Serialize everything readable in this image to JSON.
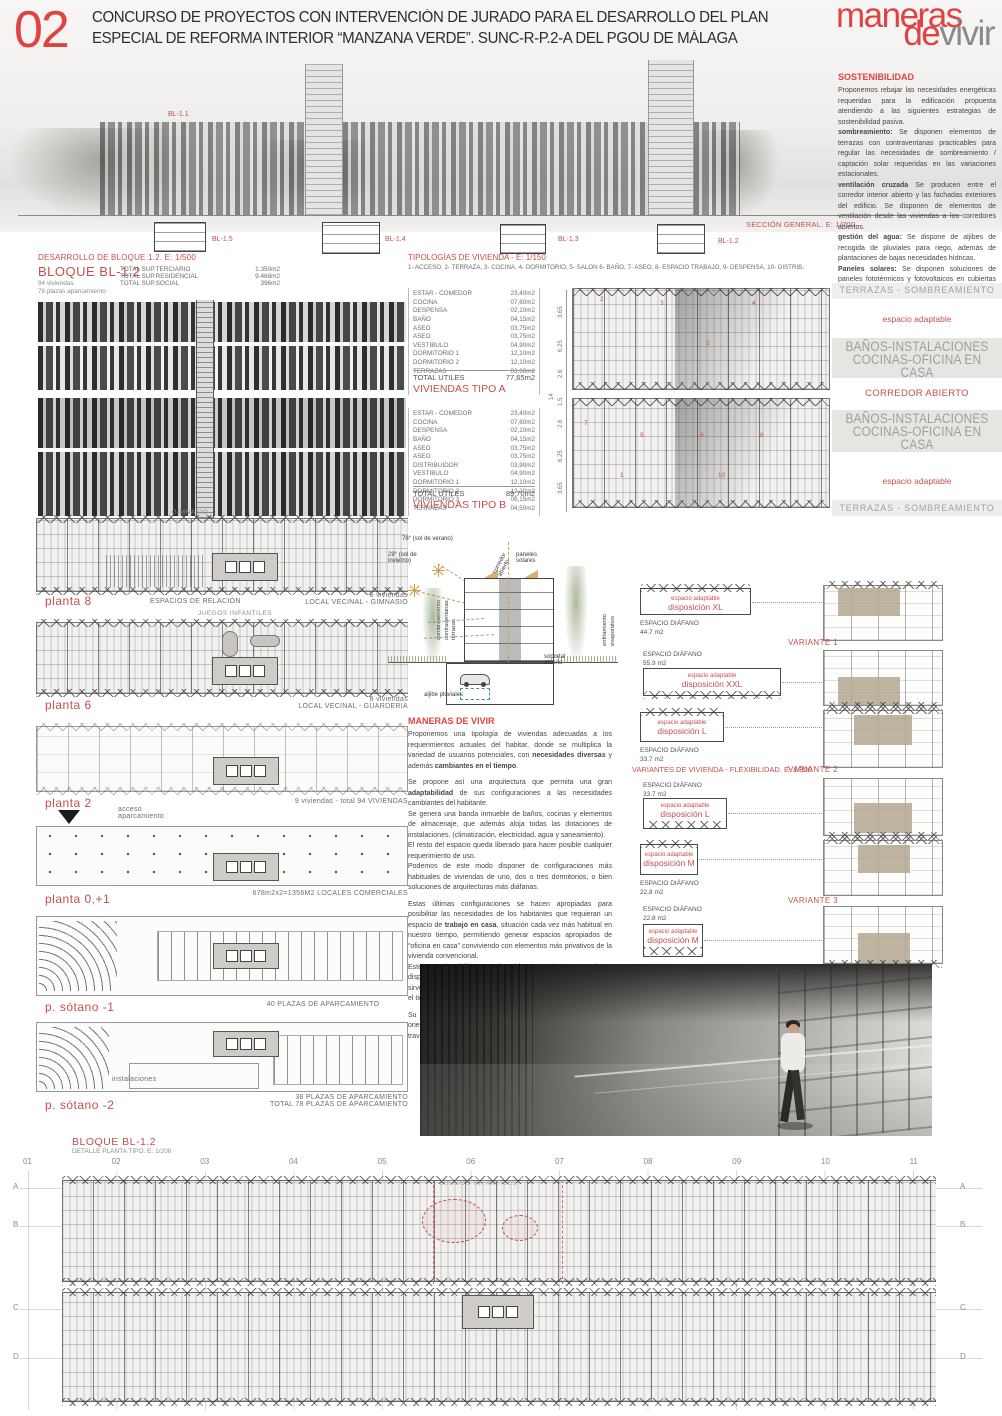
{
  "colors": {
    "accent": "#c4504e",
    "bright_red": "#e04343",
    "gray_label": "#8f8d8a",
    "tan": "#b3a791",
    "sun_orange": "#cf9b52"
  },
  "header": {
    "number": "02",
    "title_line1": "CONCURSO DE PROYECTOS CON INTERVENCIÓN DE JURADO PARA EL DESARROLLO  DEL PLAN",
    "title_line2": "ESPECIAL DE REFORMA INTERIOR “MANZANA VERDE”. SUNC-R-P.2-A  DEL  PGOU  DE  MÁLAGA",
    "logo": {
      "word1": "maneras",
      "word2": "de",
      "word3": "vivir"
    }
  },
  "seccion_general": {
    "bl_top": "BL-1.1",
    "labels": [
      "BL-1.5",
      "BL-1.4",
      "BL-1.3",
      "BL-1.2"
    ],
    "caption": "SECCIÓN GENERAL. E: 1/700"
  },
  "sostenibilidad": {
    "title": "SOSTENIBILIDAD",
    "paragraphs": [
      {
        "b": "",
        "t": "Proponemos rebajar las necesidades energéticas requeridas para la edificación propuesta atendiendo a las siguientes estrategias de sostenibilidad pasiva."
      },
      {
        "b": "sombreamiento:",
        "t": " Se disponen elementos de terrazas con contraventanas practicables para regular las necesidades de sombreamiento / captación solar requeridas en las variaciones estacionales."
      },
      {
        "b": "ventilación cruzada",
        "t": " Se producen entre el corredor interior abierto y las fachadas exteriores del edificio. Se disponen de elementos de ventilación desde las viviendas a los corredores abiertos."
      },
      {
        "b": "gestión del agua:",
        "t": " Se dispone de aljibes de recogida de pluviales para riego, además de plantaciones de bajas necesidades hídricas."
      },
      {
        "b": "Paneles solares:",
        "t": " Se disponen soluciones de paneles fototérmicos y fotovoltaicos en cubiertas para ayuda a la producción de frío/calor."
      }
    ]
  },
  "desarrollo": {
    "heading": "DESARROLLO DE BLOQUE 1.2. E: 1/500",
    "bloque": "BLOQUE  BL-1.2",
    "sub1": "94 viviendas",
    "sub2": "78 plazas aparcamiento",
    "stats": [
      {
        "label": "TOTAL SUP.TERCIARIO",
        "value": "1.350m2"
      },
      {
        "label": "TOTAL SUP.RESIDENCIAL",
        "value": "9.468m2"
      },
      {
        "label": "TOTAL SUP.SOCIAL",
        "value": "396m2"
      }
    ]
  },
  "tipologias": {
    "heading": "TIPOLOGÍAS DE VIVIENDA  -  E: 1/150",
    "legend": "1- ACCESO, 2- TERRAZA, 3- COCINA, 4- DORMITORIO, 5- SALON 6- BAÑO, 7- ASEO, 8- ESPACIO TRABAJO, 9- DESPENSA, 10- DISTRIB.",
    "tipo_a": {
      "rows": [
        [
          "ESTAR - COMEDOR",
          "23,40m2"
        ],
        [
          "COCINA",
          "07,60m2"
        ],
        [
          "DESPENSA",
          "02,10m2"
        ],
        [
          "BAÑO",
          "04,15m2"
        ],
        [
          "ASEO",
          "03,75m2"
        ],
        [
          "ASEO",
          "03,75m2"
        ],
        [
          "VESTIBULO",
          "04,90m2"
        ],
        [
          "DORMITORIO 1",
          "12,10m2"
        ],
        [
          "DORMITORIO 2",
          "12,10m2"
        ],
        [
          "TERRAZAS",
          "03,60m2"
        ]
      ],
      "total_label": "TOTAL UTILES",
      "total_value": "77,65m2",
      "name": "VIVIENDAS TIPO A"
    },
    "tipo_b": {
      "rows": [
        [
          "ESTAR - COMEDOR",
          "23,40m2"
        ],
        [
          "COCINA",
          "07,60m2"
        ],
        [
          "DESPENSA",
          "02,10m2"
        ],
        [
          "BAÑO",
          "04,15m2"
        ],
        [
          "ASEO",
          "03,75m2"
        ],
        [
          "ASEO",
          "03,75m2"
        ],
        [
          "DISTRIBUIDOR",
          "03,90m2"
        ],
        [
          "VESTIBULO",
          "04,90m2"
        ],
        [
          "DORMITORIO 1",
          "12,10m2"
        ],
        [
          "DORMITORIO 2",
          "12,10m2"
        ],
        [
          "DORMITORIO 3",
          "08,15m2"
        ],
        [
          "TERRAZAS",
          "04,50m2"
        ]
      ],
      "total_label": "TOTAL UTILES",
      "total_value": "89,70m2",
      "name": "VIVIENDAS TIPO B"
    },
    "dims_a": [
      "3.65",
      "6.25",
      "2.6"
    ],
    "dims_mid": [
      "14",
      "1.5"
    ],
    "dims_b": [
      "2.6",
      "6.25",
      "3.65"
    ],
    "plan_numbers": [
      "1",
      "2",
      "3",
      "4",
      "5",
      "6",
      "7",
      "8",
      "9",
      "10"
    ]
  },
  "franjas": {
    "top": "TERRAZAS - SOMBREAMIENTO",
    "adaptable1": "espacio adaptable",
    "banda1a": "BAÑOS-INSTALACIONES",
    "banda1b": "COCINAS-OFICINA EN CASA",
    "corredor": "CORREDOR ABIERTO",
    "banda2a": "BAÑOS-INSTALACIONES",
    "banda2b": "COCINAS-OFICINA EN CASA",
    "adaptable2": "espacio adaptable",
    "bottom": "TERRAZAS - SOMBREAMIENTO"
  },
  "plantas": {
    "gimnasio": "GIMNASIO",
    "planta8": {
      "name": "planta 8",
      "center": "ESPACIOS DE RELACIÓN",
      "right1": "8 viviendas",
      "right2": "LOCAL VECINAL - GIMNASIO"
    },
    "juegos": "JUEGOS INFANTILES",
    "planta6": {
      "name": "planta 6",
      "right1": "8 viviendas",
      "right2": "LOCAL VECINAL - GUARDERIA"
    },
    "planta2": {
      "name": "planta 2",
      "right1": "9 viviendas - total 94 VIVIENDAS",
      "acceso1": "acceso",
      "acceso2": "aparcamiento"
    },
    "planta01": {
      "name": "planta 0,+1",
      "right1": "678m2x2=1356M2 LOCALES COMERCIALES"
    },
    "sotano1": {
      "name": "p. sótano -1",
      "right1": "40 PLAZAS DE APARCAMIENTO"
    },
    "sotano2": {
      "name": "p. sótano -2",
      "inner": "instalaciones",
      "right1": "38 PLAZAS DE APARCAMIENTO",
      "right2": "TOTAL 78 PLAZAS DE APARCAMIENTO"
    }
  },
  "esquema": {
    "sol1": "78° (sol de verano)",
    "sol2": "29° (sol de invierno)",
    "vertical": "sombreamiento contraventanas terrazas",
    "corredor": "corredor abierto",
    "paneles": "paneles solares",
    "enfriamiento": "enfriamiento evaporativo",
    "soportal": "soportal abierto",
    "aljibe": "aljibe pluviales"
  },
  "maneras": {
    "title": "MANERAS DE VIVIR",
    "p1": [
      {
        "t": "Proponemos una tipología de viviendas adecuadas a los requerimientos actuales del habitar, donde se multiplica la variedad de usuarios potenciales, con "
      },
      {
        "t": "necesidades diversas",
        "b": 1
      },
      {
        "t": " y además "
      },
      {
        "t": "cambiantes en el tiempo",
        "b": 1
      },
      {
        "t": "."
      }
    ],
    "p2": [
      {
        "t": "Se propone así una arquitectura que permita una gran "
      },
      {
        "t": "adaptabilidad",
        "b": 1
      },
      {
        "t": " de sus configuraciones a las necesidades cambiantes del habitante."
      }
    ],
    "p3": [
      {
        "t": "Se genera una banda inmueble de baños, cocinas y elementos de almacenaje, que además aloja todas las dotaciones de instalaciones. (climatización, electricidad, agua y saneamiento)."
      }
    ],
    "p4": [
      {
        "t": "El resto del espacio queda liberado para hacer posible cualquier requerimiento de uso."
      }
    ],
    "p5": [
      {
        "t": "Podemos de este modo disponer de configuraciones más habituales de viviendas de uno, dos o tres dormitorios, o bien soluciones de arquitecturas más diáfanas."
      }
    ],
    "p6": [
      {
        "t": "Estas últimas configuraciones se hacen apropiadas para posibilitar las necesidades de los habitantes que requieran un espacio de "
      },
      {
        "t": "trabajo en casa",
        "b": 1
      },
      {
        "t": ", situación cada vez más habitual en nuestro tiempo, permitiendo generar espacios apropiados de “oficina en casa” conviviendo con elementos más privativos de la vivienda convencional."
      }
    ],
    "p7": [
      {
        "t": "Este espacio diáfano y adaptable es totalmente exterior y dispone de una solución continua de miradores/terrazas, que sirven para atenuar la luz natural y captación solar requerida en el tiempo."
      }
    ],
    "p8": [
      {
        "t": "Su peculiar disposición esquinada permite diferentes orientaciones, y distintos modos de oscurecimiento/captación a través de los elementos sombreadores tipo contraventanas."
      }
    ]
  },
  "variantes": {
    "heading": "VARIANTES DE VIVIENDA - FLEXIBILIDAD. E: 1/300",
    "v1": "VARIANTE 1",
    "v2": "VARIANTE 2",
    "v3": "VARIANTE 3",
    "rows": [
      {
        "box1": "espacio adaptable",
        "box2": "disposición XL",
        "dif": "ESPACIO DIÁFANO",
        "m2": "44.7 m2"
      },
      {
        "box1": "espacio adaptable",
        "box2": "disposición XXL",
        "dif": "ESPACIO DIÁFANO",
        "m2": "55.9 m2"
      },
      {
        "box1": "espacio adaptable",
        "box2": "disposición L",
        "dif": "ESPACIO DIÁFANO",
        "m2": "33.7 m2"
      },
      {
        "box1": "espacio adaptable",
        "box2": "disposición L",
        "dif": "ESPACIO DIÁFANO",
        "m2": "33.7 m2"
      },
      {
        "box1": "espacio adaptable",
        "box2": "disposición M",
        "dif": "ESPACIO DIÁFANO",
        "m2": "22.8 m2"
      },
      {
        "box1": "espacio adaptable",
        "box2": "disposición M",
        "dif": "ESPACIO DIÁFANO",
        "m2": "22.8 m2"
      }
    ]
  },
  "detalle": {
    "bloque": "BLOQUE  BL-1.2",
    "sub": "DETALLE PLANTA TIPO. E: 1/200",
    "cols": [
      "01",
      "02",
      "03",
      "04",
      "05",
      "06",
      "07",
      "08",
      "09",
      "10",
      "11"
    ],
    "rows": [
      "A",
      "B",
      "C",
      "D"
    ],
    "plan_label": "JUEGOS INFANTILES"
  }
}
